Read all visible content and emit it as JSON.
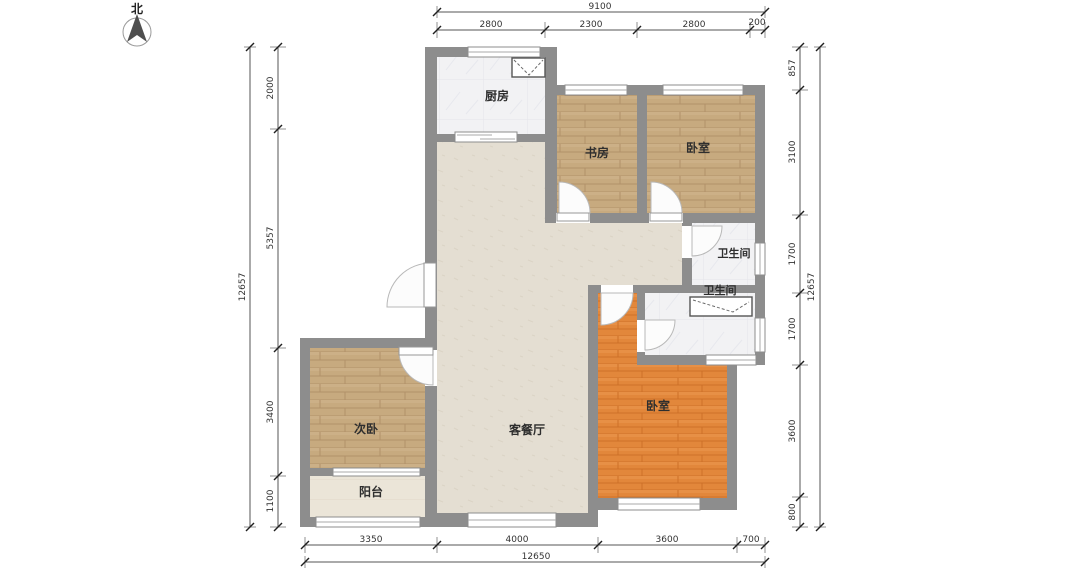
{
  "north": {
    "label": "北"
  },
  "rooms": {
    "kitchen": "厨房",
    "study": "书房",
    "bedroom_top": "卧室",
    "bath_upper": "卫生间",
    "bath_lower": "卫生间",
    "living_dining": "客餐厅",
    "master_bedroom": "卧室",
    "secondary_bedroom": "次卧",
    "balcony": "阳台"
  },
  "dims": {
    "top": {
      "total": "9100",
      "segs": [
        "2800",
        "2300",
        "2800",
        "200"
      ]
    },
    "bottom": {
      "total": "12650",
      "segs": [
        "3350",
        "4000",
        "3600",
        "700"
      ]
    },
    "left": {
      "total": "12657",
      "segs": [
        "2000",
        "5357",
        "3400",
        "1100"
      ]
    },
    "right": {
      "total": "12657",
      "segs": [
        "857",
        "3100",
        "1700",
        "1700",
        "3600",
        "800"
      ]
    }
  },
  "colors": {
    "wall": "#8d8d8d",
    "wood_floor": "#c7aa7f",
    "orange_floor": "#e2873b",
    "beige_floor": "#e4ded2",
    "tile_floor": "#ebe5d8",
    "marble_floor": "#f2f2f4"
  }
}
